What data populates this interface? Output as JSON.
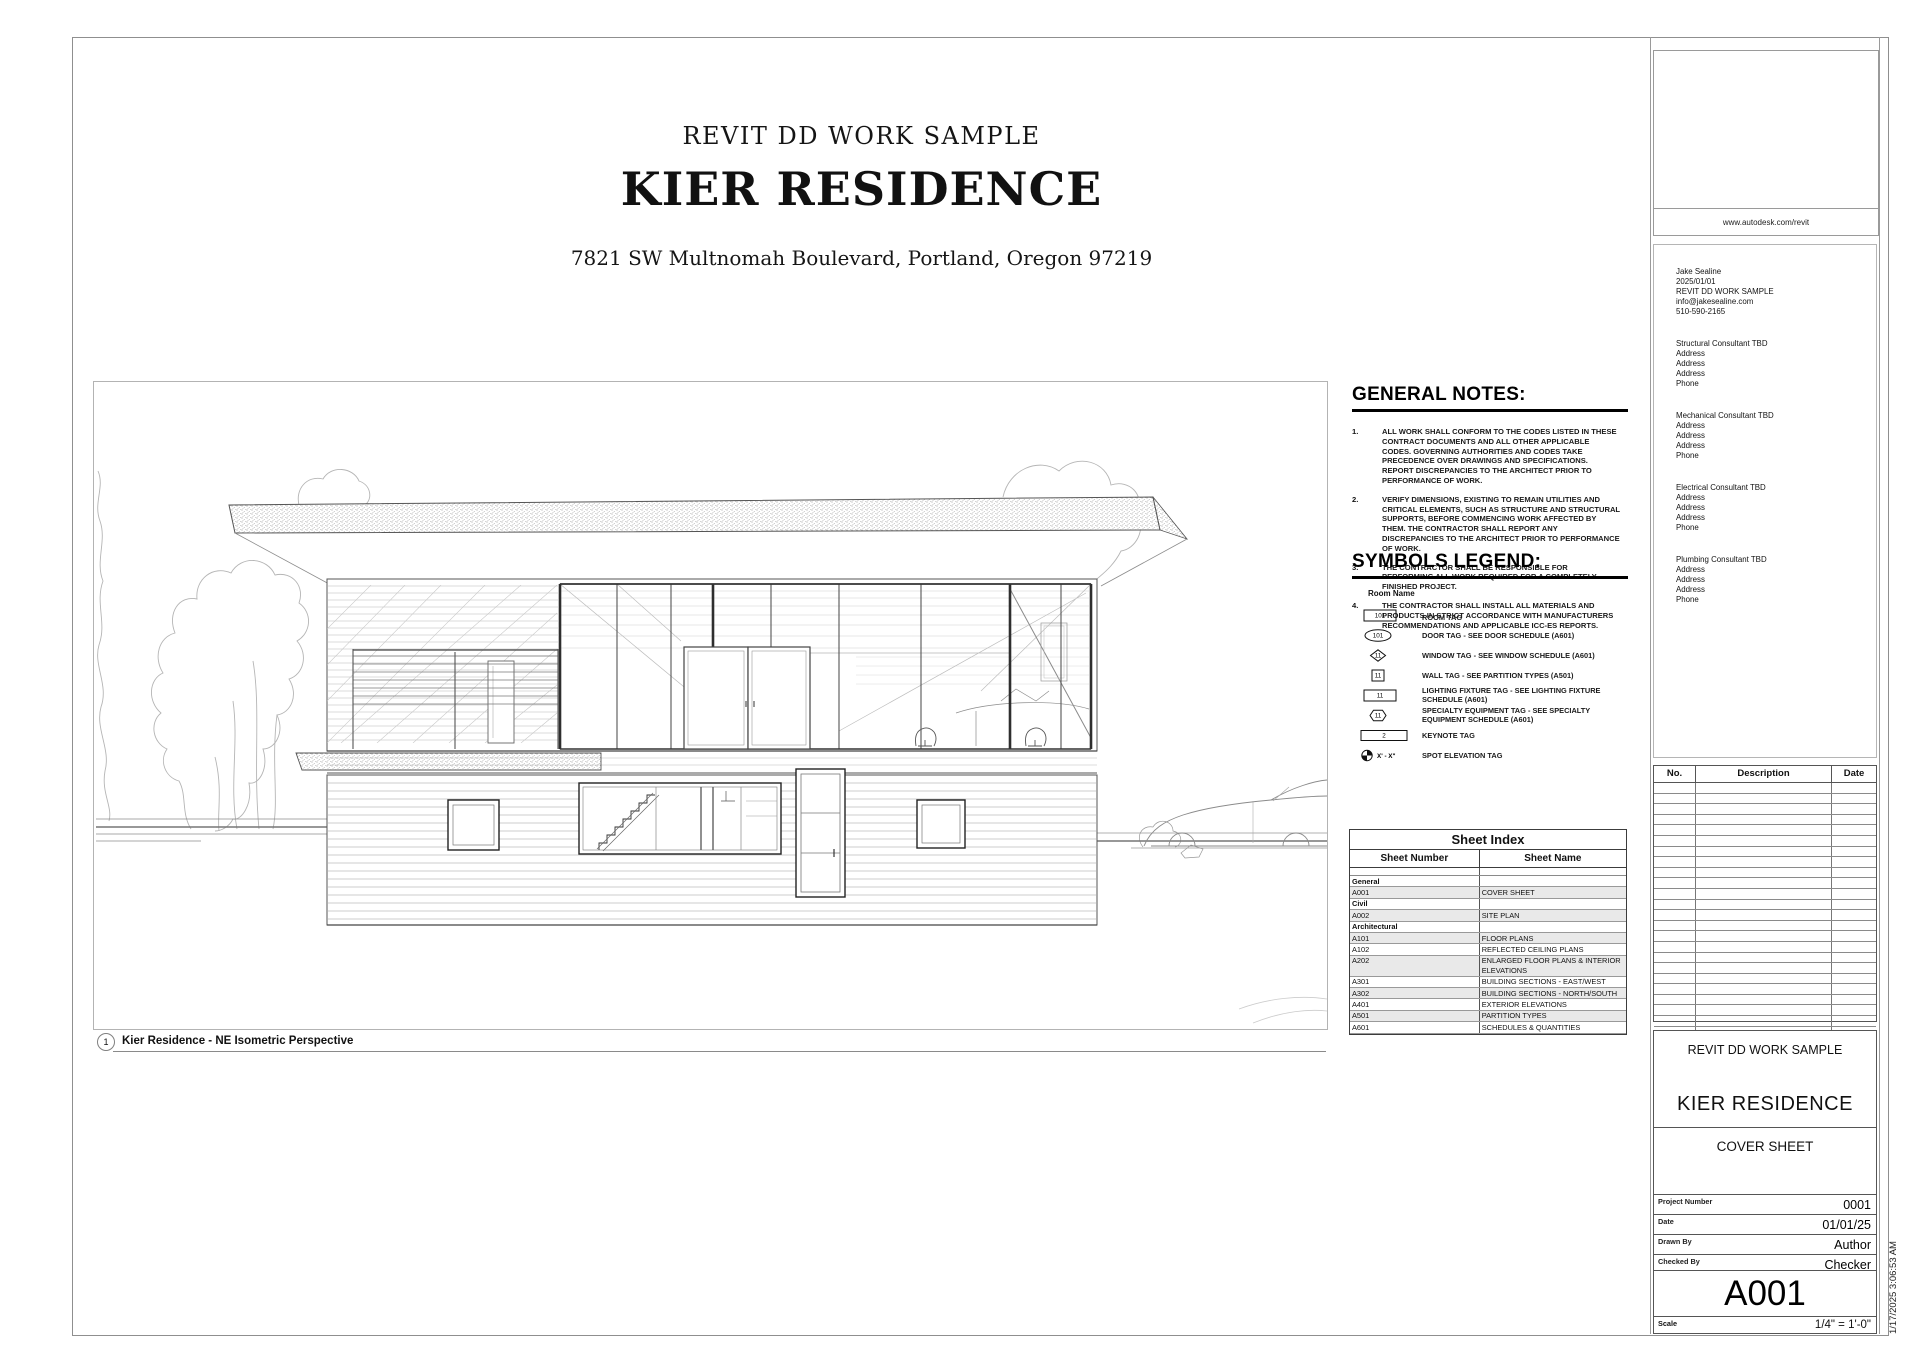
{
  "cover": {
    "project_label": "REVIT DD WORK SAMPLE",
    "project_name": "KIER RESIDENCE",
    "address": "7821 SW Multnomah Boulevard, Portland, Oregon 97219"
  },
  "viewport_caption": {
    "detail_number": "1",
    "title": "Kier Residence - NE Isometric Perspective"
  },
  "general_notes": {
    "heading": "GENERAL NOTES:",
    "items": [
      "ALL WORK SHALL CONFORM TO THE CODES LISTED IN THESE CONTRACT DOCUMENTS AND ALL OTHER APPLICABLE CODES. GOVERNING AUTHORITIES AND CODES TAKE PRECEDENCE OVER DRAWINGS AND SPECIFICATIONS. REPORT DISCREPANCIES TO THE ARCHITECT PRIOR TO PERFORMANCE OF WORK.",
      "VERIFY DIMENSIONS, EXISTING TO REMAIN UTILITIES AND CRITICAL ELEMENTS, SUCH AS STRUCTURE AND STRUCTURAL SUPPORTS, BEFORE COMMENCING WORK AFFECTED BY THEM. THE CONTRACTOR SHALL REPORT ANY DISCREPANCIES TO THE ARCHITECT PRIOR TO PERFORMANCE OF WORK.",
      "THE CONTRACTOR SHALL BE RESPONSIBLE FOR PERFORMING ALL WORK REQUIRED FOR A COMPLETELY FINISHED PROJECT.",
      "THE CONTRACTOR SHALL INSTALL ALL MATERIALS AND PRODUCTS IN STRICT ACCORDANCE WITH MANUFACTURERS RECOMMENDATIONS AND APPLICABLE ICC-ES REPORTS."
    ]
  },
  "symbols_legend": {
    "heading": "SYMBOLS LEGEND:",
    "room_name_label": "Room Name",
    "items": [
      {
        "shape": "rect",
        "tag": "101",
        "label": "ROOM TAG"
      },
      {
        "shape": "ellipse",
        "tag": "101",
        "label": "DOOR TAG - SEE DOOR SCHEDULE (A601)"
      },
      {
        "shape": "diamond",
        "tag": "11",
        "label": "WINDOW TAG - SEE WINDOW SCHEDULE (A601)"
      },
      {
        "shape": "square",
        "tag": "11",
        "label": "WALL TAG - SEE PARTITION TYPES (A501)"
      },
      {
        "shape": "rect",
        "tag": "11",
        "label": "LIGHTING FIXTURE TAG - SEE LIGHTING FIXTURE SCHEDULE (A601)"
      },
      {
        "shape": "hexagon",
        "tag": "11",
        "label": "SPECIALTY EQUIPMENT TAG - SEE SPECIALTY EQUIPMENT SCHEDULE (A601)"
      },
      {
        "shape": "keynote",
        "tag": "2",
        "label": "KEYNOTE TAG"
      },
      {
        "shape": "spot",
        "tag": "X' - X\"",
        "label": "SPOT ELEVATION TAG"
      }
    ]
  },
  "sheet_index": {
    "title": "Sheet Index",
    "col_number": "Sheet Number",
    "col_name": "Sheet Name",
    "rows": [
      {
        "number": "General",
        "name": "",
        "group": true
      },
      {
        "number": "A001",
        "name": "COVER SHEET"
      },
      {
        "number": "Civil",
        "name": "",
        "group": true
      },
      {
        "number": "A002",
        "name": "SITE PLAN"
      },
      {
        "number": "Architectural",
        "name": "",
        "group": true
      },
      {
        "number": "A101",
        "name": "FLOOR PLANS"
      },
      {
        "number": "A102",
        "name": "REFLECTED CEILING PLANS"
      },
      {
        "number": "A202",
        "name": "ENLARGED FLOOR PLANS & INTERIOR ELEVATIONS"
      },
      {
        "number": "A301",
        "name": "BUILDING SECTIONS - EAST/WEST"
      },
      {
        "number": "A302",
        "name": "BUILDING SECTIONS - NORTH/SOUTH"
      },
      {
        "number": "A401",
        "name": "EXTERIOR ELEVATIONS"
      },
      {
        "number": "A501",
        "name": "PARTITION TYPES"
      },
      {
        "number": "A601",
        "name": "SCHEDULES & QUANTITIES"
      }
    ]
  },
  "logo_box": {
    "url": "www.autodesk.com/revit"
  },
  "contact": {
    "owner_lines": [
      "Jake Sealine",
      "2025/01/01",
      "REVIT DD WORK SAMPLE",
      "info@jakesealine.com",
      "510-590-2165"
    ],
    "consultants": [
      {
        "title": "Structural Consultant TBD",
        "lines": [
          "Address",
          "Address",
          "Address",
          "Phone"
        ]
      },
      {
        "title": "Mechanical Consultant TBD",
        "lines": [
          "Address",
          "Address",
          "Address",
          "Phone"
        ]
      },
      {
        "title": "Electrical Consultant TBD",
        "lines": [
          "Address",
          "Address",
          "Address",
          "Phone"
        ]
      },
      {
        "title": "Plumbing Consultant TBD",
        "lines": [
          "Address",
          "Address",
          "Address",
          "Phone"
        ]
      }
    ]
  },
  "revision_table": {
    "col_no": "No.",
    "col_description": "Description",
    "col_date": "Date",
    "empty_row_count": 24
  },
  "title_block": {
    "project_label": "REVIT DD WORK SAMPLE",
    "project_name": "KIER RESIDENCE",
    "sheet_title": "COVER SHEET",
    "fields": [
      {
        "label": "Project Number",
        "value": "0001"
      },
      {
        "label": "Date",
        "value": "01/01/25"
      },
      {
        "label": "Drawn By",
        "value": "Author"
      },
      {
        "label": "Checked By",
        "value": "Checker"
      }
    ],
    "sheet_number": "A001",
    "scale_label": "Scale",
    "scale_value": "1/4\" = 1'-0\""
  },
  "print_stamp": "1/17/2025 3:06:53 AM"
}
